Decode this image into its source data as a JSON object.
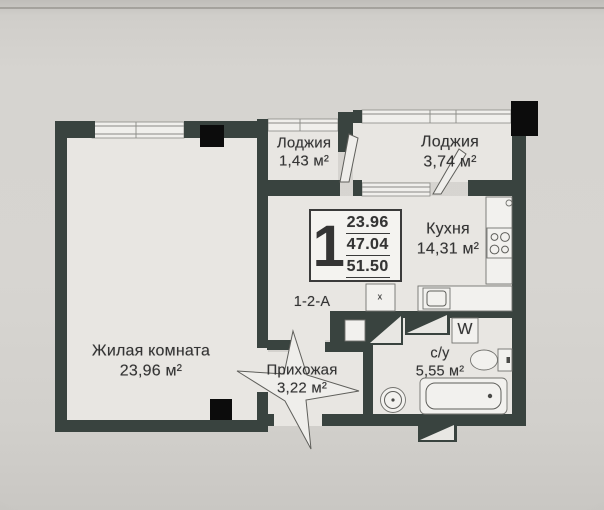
{
  "plan": {
    "badge": {
      "rooms_count": "1",
      "area_lines": [
        "23.96",
        "47.04",
        "51.50"
      ]
    },
    "unit_code": "1-2-А",
    "rooms": {
      "loggia_small": {
        "name": "Лоджия",
        "area": "1,43 м²"
      },
      "loggia_large": {
        "name": "Лоджия",
        "area": "3,74 м²"
      },
      "kitchen": {
        "name": "Кухня",
        "area": "14,31 м²"
      },
      "living_room": {
        "name": "Жилая комната",
        "area": "23,96 м²"
      },
      "hallway": {
        "name": "Прихожая",
        "area": "3,22 м²"
      },
      "bathroom": {
        "name": "с/у",
        "area": "5,55 м²"
      }
    },
    "labels": {
      "washing_machine": "W",
      "vent_shaft": "x"
    },
    "icons": [
      "stove-icon",
      "kitchen-sink-icon",
      "washing-machine-icon",
      "toilet-icon",
      "bathtub-icon",
      "round-sink-icon",
      "vent-shaft-icon",
      "door-leaf-icon",
      "entrance-door-swing-icon",
      "window-glazing-icon",
      "socket-icon"
    ],
    "colors": {
      "wall": "#39433f",
      "column": "#0c0c0c",
      "room_fill": "#e8e6e2",
      "photo_background": "#d5d3cf",
      "text": "#343434"
    }
  }
}
